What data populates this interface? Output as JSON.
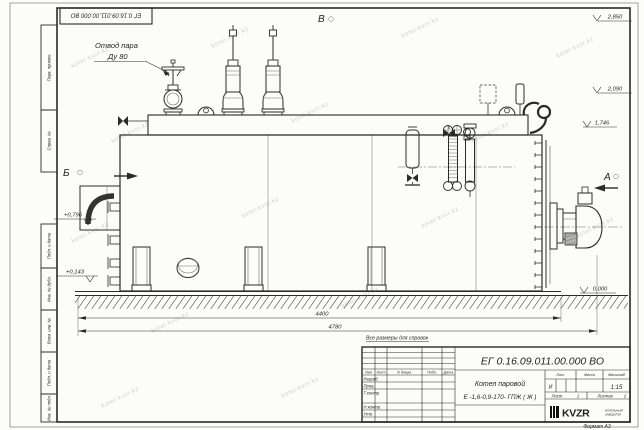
{
  "colors": {
    "line": "#2b2b2b",
    "paper": "#fcfcfa",
    "watermark": "#8a8377"
  },
  "sheet": {
    "doc_number_flipped": "ЕГ 0.16.09.011.00.000  ВО",
    "format_label": "Формат А3",
    "reference_note": "Все размеры для справок",
    "watermark": "kotel-kvzr.kz"
  },
  "margin_stamps": {
    "perv_primen": "Перв. примен.",
    "sprav_no": "Справ. №",
    "podp_data_1": "Подп. и дата",
    "inv_dubl": "Инв. № дубл.",
    "vzam_inv": "Взам. инв. №",
    "podp_data_2": "Подп. и дата",
    "inv_podl": "Инв. № подл."
  },
  "annotations": {
    "steam_outlet_line1": "Отвод пара",
    "steam_outlet_line2": "Ду 80",
    "view_a": "А",
    "view_b": "Б",
    "view_v": "В"
  },
  "elevations": {
    "e2850": "2,850",
    "e2090": "2,090",
    "e1746": "1,746",
    "e0000": "0,000",
    "e0796": "+0,796",
    "e0143": "+0,143"
  },
  "dimensions": {
    "length_main": "4400",
    "length_overall": "4780"
  },
  "title_block": {
    "doc_number": "ЕГ 0.16.09.011.00.000  ВО",
    "product_line1": "Котел паровой",
    "product_line2": "Е -1,6-0,9-170- ГПЖ ( Ж )",
    "col_izm": "Изм",
    "col_list": "Лист",
    "col_dokum": "N докум.",
    "col_podp": "Подп.",
    "col_data": "Дата",
    "row_razrab": "Разраб.",
    "row_prov": "Пров.",
    "row_tkontr": "Т.контр.",
    "row_nkontr": "Н.контр.",
    "row_utv": "Утв.",
    "lit_header": "Лит.",
    "lit_value": "И",
    "massa_header": "Масса",
    "masshtab_header": "Масштаб",
    "masshtab_value": "1:15",
    "list_label": "Лист",
    "list_value": "1",
    "listov_label": "Листов",
    "listov_value": "2",
    "logo_text": "KVZR",
    "logo_sub1": "КОТЕЛЬНЫЙ",
    "logo_sub2": "ЗАВОД РЭП"
  }
}
